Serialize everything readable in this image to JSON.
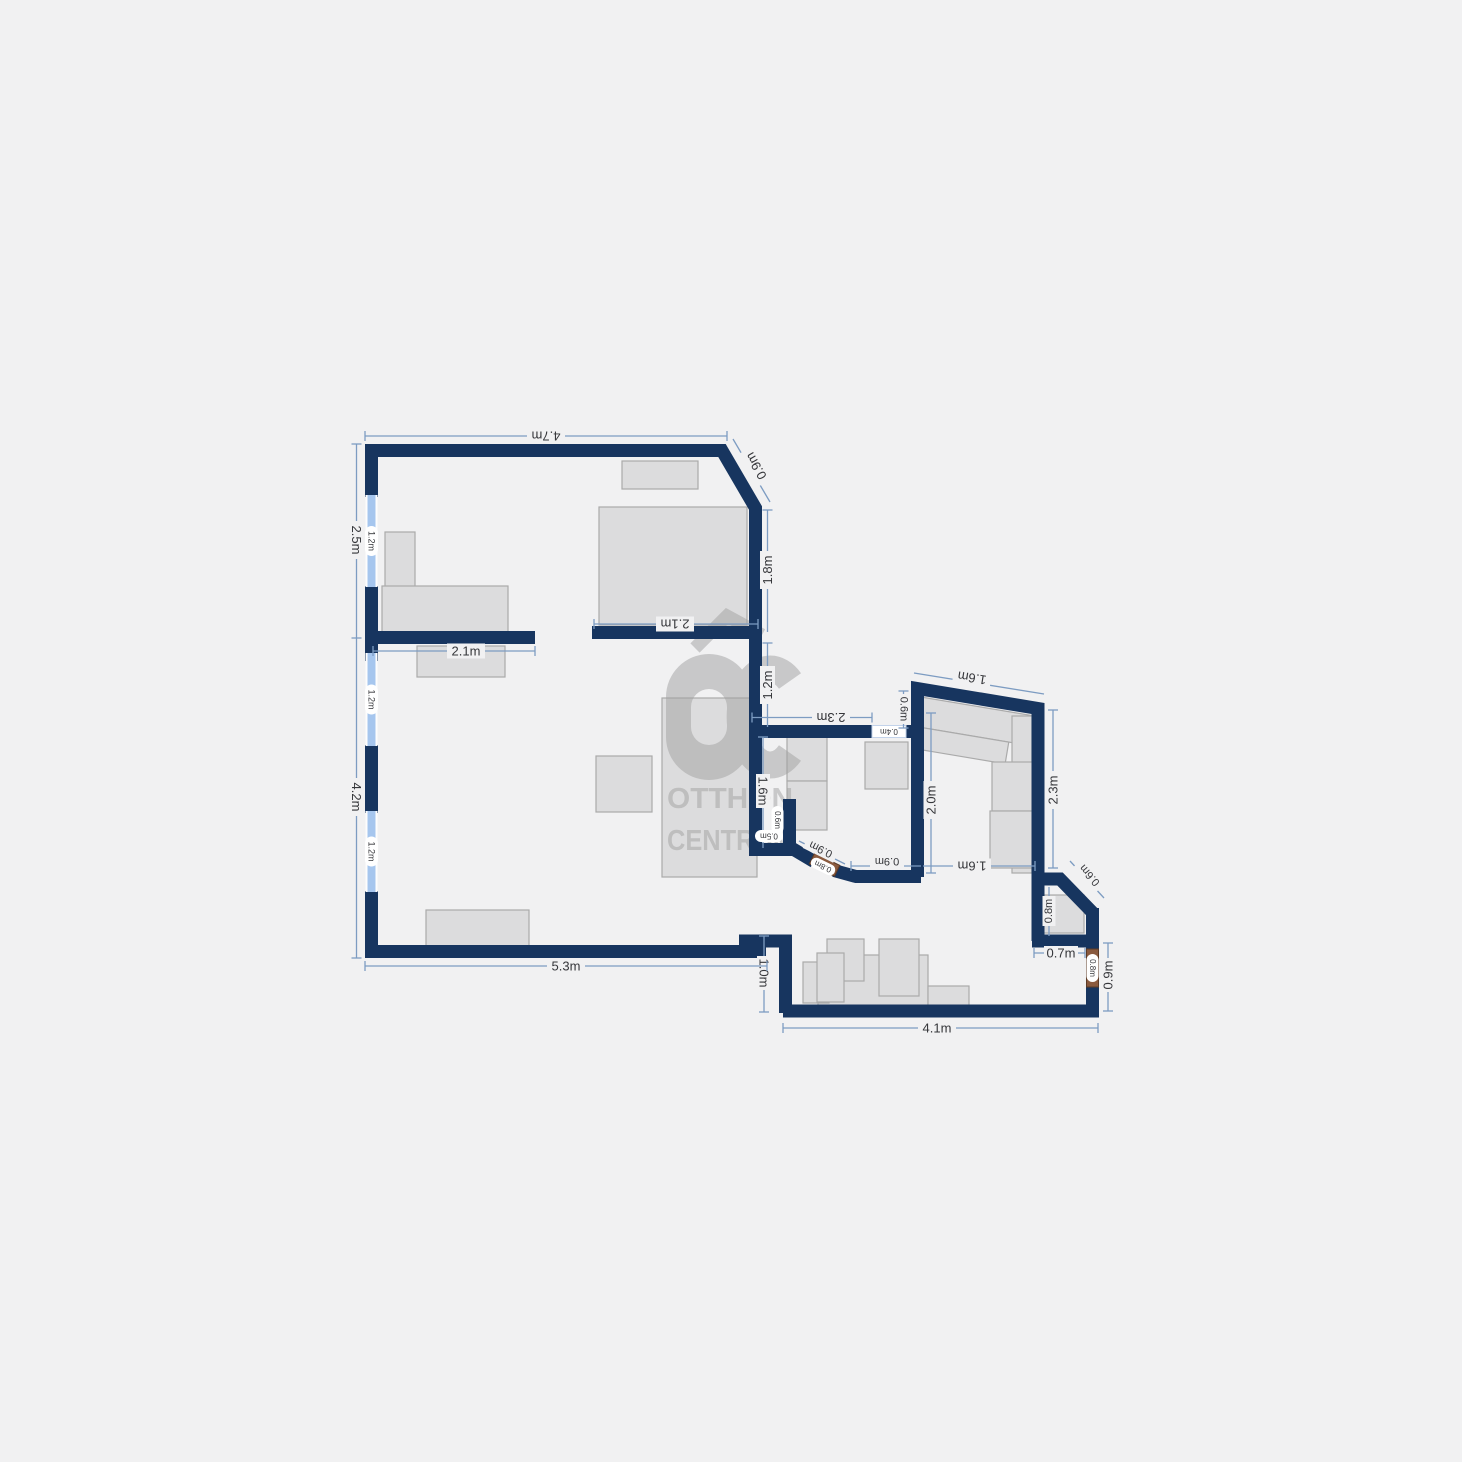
{
  "dims": {
    "top_width": "4.7m",
    "top_diagonal": "0.9m",
    "left_upper": "2.5m",
    "left_lower": "4.2m",
    "window_upper": "1.2m",
    "window_middle": "1.2m",
    "window_lower": "1.2m",
    "bedroom_wall_left": "2.1m",
    "bedroom_wall_right": "2.1m",
    "east_upper": "1.8m",
    "east_lower": "1.2m",
    "hall_top": "2.3m",
    "hall_opening": "0.4m",
    "kitchen_west": "0.6m",
    "kitchen_top": "1.6m",
    "kitchen_inner": "2.0m",
    "kitchen_east": "2.3m",
    "kitchen_bottom": "1.6m",
    "alcove_height": "1.6m",
    "alcove_depth": "0.6m",
    "alcove_width": "0.5m",
    "entry_diag_width": "0.9m",
    "entry_door": "0.8m",
    "entry_wall": "0.9m",
    "bath_diagonal": "0.6m",
    "bath_width": "0.8m",
    "bath_bottom": "0.7m",
    "side_door": "0.8m",
    "side_wall": "0.9m",
    "lower_left": "1.0m",
    "bottom_right": "4.1m",
    "bottom_left": "5.3m"
  },
  "watermark": {
    "logo": "OC",
    "line1": "OTTHON",
    "line2": "CENTRUM"
  },
  "colors": {
    "wall": "#17355f",
    "window": "#a6c6ee",
    "door": "#8a5a3e",
    "dim_line": "#7d9cc2",
    "background": "#f1f1f2",
    "furniture": "#dbdbdc",
    "watermark": "#a0a0a0"
  }
}
